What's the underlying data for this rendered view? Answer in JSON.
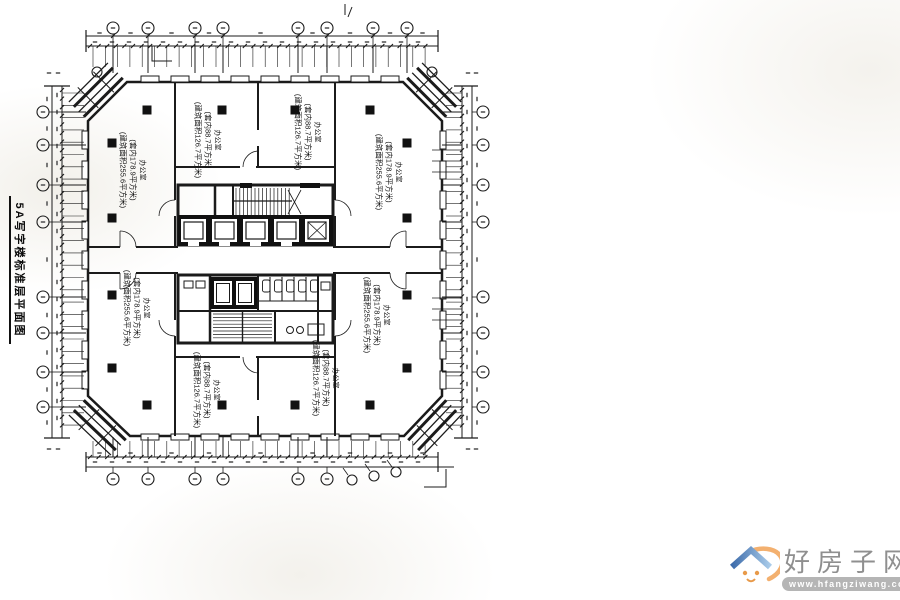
{
  "title": "5A写字楼标准层平面图",
  "rooms": [
    {
      "id": "office-top-left",
      "name": "办公室",
      "area_inner": "(套内178.9平方米)",
      "area_built": "(建筑面积255.6平方米)"
    },
    {
      "id": "office-top-mid-left",
      "name": "办公室",
      "area_inner": "(套内88.7平方米)",
      "area_built": "(建筑面积126.7平方米)"
    },
    {
      "id": "office-top-mid-right",
      "name": "办公室",
      "area_inner": "(套内88.7平方米)",
      "area_built": "(建筑面积126.7平方米)"
    },
    {
      "id": "office-top-right",
      "name": "办公室",
      "area_inner": "(套内178.9平方米)",
      "area_built": "(建筑面积255.6平方米)"
    },
    {
      "id": "office-bottom-left",
      "name": "办公室",
      "area_inner": "(套内178.9平方米)",
      "area_built": "(建筑面积255.6平方米)"
    },
    {
      "id": "office-bottom-mid-left",
      "name": "办公室",
      "area_inner": "(套内88.7平方米)",
      "area_built": "(建筑面积126.7平方米)"
    },
    {
      "id": "office-bottom-mid-right",
      "name": "办公室",
      "area_inner": "(套内88.7平方米)",
      "area_built": "(建筑面积126.7平方米)"
    },
    {
      "id": "office-bottom-right",
      "name": "办公室",
      "area_inner": "(套内178.9平方米)",
      "area_built": "(建筑面积255.6平方米)"
    }
  ],
  "watermark": {
    "site_name": "好房子网",
    "site_url": "www.hfangziwang.com"
  },
  "colors": {
    "line": "#1b1b1b",
    "roof_dark": "#3d6cab",
    "roof_light": "#a9cbe9",
    "swoosh": "#f2a75f",
    "accent_orange": "#e89a4a",
    "watermark_text": "#8f8f8f",
    "url_bar": "#b5b5b5"
  }
}
